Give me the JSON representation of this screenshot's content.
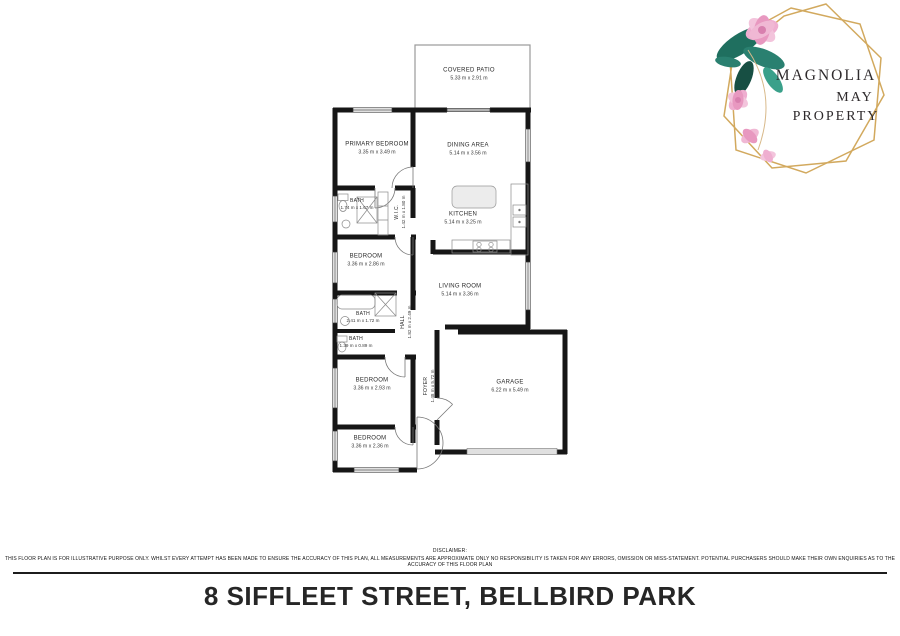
{
  "logo": {
    "line1": "MAGNOLIA",
    "line2": "MAY",
    "line3": "PROPERTY"
  },
  "floorplan": {
    "rooms": [
      {
        "name": "COVERED PATIO",
        "dims": "5.33 m x 2.91 m"
      },
      {
        "name": "PRIMARY BEDROOM",
        "dims": "3.35 m x 3.49 m"
      },
      {
        "name": "DINING AREA",
        "dims": "5.14 m x 3.56 m"
      },
      {
        "name": "BATH",
        "dims": "1.74 m x 1.67 m"
      },
      {
        "name": "W.I.C.",
        "dims": "1.42 m x 1.80 m"
      },
      {
        "name": "BEDROOM",
        "dims": "3.36 m x 2.86 m"
      },
      {
        "name": "KITCHEN",
        "dims": "5.14 m x 3.25 m"
      },
      {
        "name": "LIVING ROOM",
        "dims": "5.14 m x 3.36 m"
      },
      {
        "name": "BATH",
        "dims": "2.41 m x 1.72 m"
      },
      {
        "name": "HALL",
        "dims": "1.82 m x 2.49 m"
      },
      {
        "name": "BATH",
        "dims": "1.39 m x 0.89 m"
      },
      {
        "name": "BEDROOM",
        "dims": "3.36 m x 2.93 m"
      },
      {
        "name": "FOYER",
        "dims": "1.48 m x 5.72 m"
      },
      {
        "name": "BEDROOM",
        "dims": "3.36 m x 2.36 m"
      },
      {
        "name": "GARAGE",
        "dims": "6.22 m x 5.49 m"
      }
    ]
  },
  "footer": {
    "disclaimer_heading": "DISCLAIMER:",
    "disclaimer_text": "THIS FLOOR PLAN IS FOR ILLUSTRATIVE PURPOSE ONLY. WHILST EVERY ATTEMPT HAS BEEN MADE TO ENSURE THE ACCURACY OF THIS PLAN, ALL MEASUREMENTS ARE APPROXIMATE ONLY NO RESPONSIBILITY IS TAKEN FOR ANY ERRORS, OMISSION OR MISS-STATEMENT. POTENTIAL PURCHASERS SHOULD MAKE THEIR OWN ENQUIRIES AS TO THE ACCURACY OF THIS FLOOR PLAN",
    "title": "8 SIFFLEET STREET, BELLBIRD PARK"
  },
  "colors": {
    "wall": "#161616",
    "logo_gold": "#d2a95e",
    "leaf_green": "#2a8070",
    "petal_pink": "#efaed0",
    "title_text": "#262626"
  }
}
